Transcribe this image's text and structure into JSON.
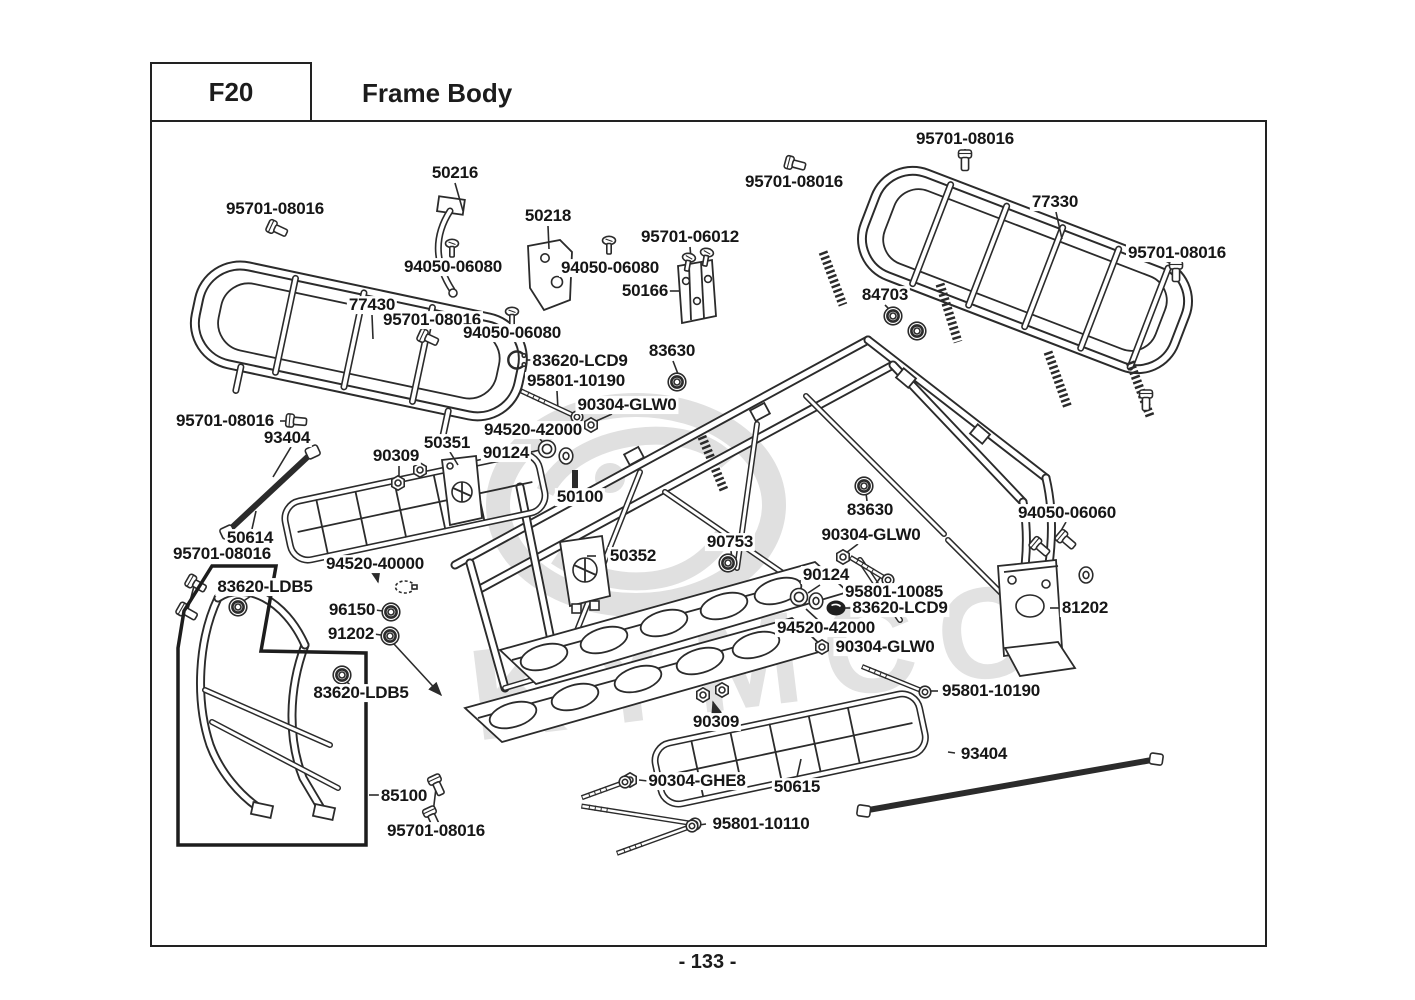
{
  "header": {
    "code": "F20",
    "title": "Frame Body"
  },
  "footer": {
    "page_number": "- 133 -"
  },
  "watermark": {
    "brand": "KYMCO"
  },
  "colors": {
    "line": "#2b2b2b",
    "label_text": "#161616",
    "border": "#222222",
    "watermark": "#e0e0e0",
    "background": "#ffffff"
  },
  "diagram": {
    "labels": [
      {
        "text": "95701-08016",
        "x": 275,
        "y": 209
      },
      {
        "text": "50216",
        "x": 455,
        "y": 173
      },
      {
        "text": "94050-06080",
        "x": 453,
        "y": 267
      },
      {
        "text": "50218",
        "x": 548,
        "y": 216
      },
      {
        "text": "94050-06080",
        "x": 610,
        "y": 268
      },
      {
        "text": "95701-06012",
        "x": 690,
        "y": 237
      },
      {
        "text": "50166",
        "x": 645,
        "y": 291
      },
      {
        "text": "95701-08016",
        "x": 965,
        "y": 139
      },
      {
        "text": "95701-08016",
        "x": 794,
        "y": 182
      },
      {
        "text": "77330",
        "x": 1055,
        "y": 202
      },
      {
        "text": "95701-08016",
        "x": 1177,
        "y": 253
      },
      {
        "text": "84703",
        "x": 885,
        "y": 295
      },
      {
        "text": "77430",
        "x": 372,
        "y": 305
      },
      {
        "text": "95701-08016",
        "x": 432,
        "y": 320
      },
      {
        "text": "94050-06080",
        "x": 512,
        "y": 333
      },
      {
        "text": "83620-LCD9",
        "x": 580,
        "y": 361
      },
      {
        "text": "83630",
        "x": 672,
        "y": 351
      },
      {
        "text": "95801-10190",
        "x": 576,
        "y": 381
      },
      {
        "text": "90304-GLW0",
        "x": 627,
        "y": 405
      },
      {
        "text": "94520-42000",
        "x": 533,
        "y": 430
      },
      {
        "text": "90124",
        "x": 506,
        "y": 453
      },
      {
        "text": "95701-08016",
        "x": 225,
        "y": 421
      },
      {
        "text": "93404",
        "x": 287,
        "y": 438
      },
      {
        "text": "90309",
        "x": 396,
        "y": 456
      },
      {
        "text": "50351",
        "x": 447,
        "y": 443
      },
      {
        "text": "50100",
        "x": 580,
        "y": 497
      },
      {
        "text": "50614",
        "x": 250,
        "y": 538
      },
      {
        "text": "95701-08016",
        "x": 222,
        "y": 554
      },
      {
        "text": "94520-40000",
        "x": 375,
        "y": 564
      },
      {
        "text": "83620-LDB5",
        "x": 265,
        "y": 587
      },
      {
        "text": "96150",
        "x": 352,
        "y": 610
      },
      {
        "text": "91202",
        "x": 351,
        "y": 634
      },
      {
        "text": "83620-LDB5",
        "x": 361,
        "y": 693
      },
      {
        "text": "50352",
        "x": 633,
        "y": 556
      },
      {
        "text": "90753",
        "x": 730,
        "y": 542
      },
      {
        "text": "83630",
        "x": 870,
        "y": 510
      },
      {
        "text": "90304-GLW0",
        "x": 871,
        "y": 535
      },
      {
        "text": "90124",
        "x": 826,
        "y": 575
      },
      {
        "text": "95801-10085",
        "x": 894,
        "y": 592
      },
      {
        "text": "83620-LCD9",
        "x": 900,
        "y": 608
      },
      {
        "text": "94520-42000",
        "x": 826,
        "y": 628
      },
      {
        "text": "90304-GLW0",
        "x": 885,
        "y": 647
      },
      {
        "text": "94050-06060",
        "x": 1067,
        "y": 513
      },
      {
        "text": "81202",
        "x": 1085,
        "y": 608
      },
      {
        "text": "95801-10190",
        "x": 991,
        "y": 691
      },
      {
        "text": "90309",
        "x": 716,
        "y": 722
      },
      {
        "text": "50615",
        "x": 797,
        "y": 787
      },
      {
        "text": "90304-GHE8",
        "x": 697,
        "y": 781
      },
      {
        "text": "93404",
        "x": 984,
        "y": 754
      },
      {
        "text": "95801-10110",
        "x": 761,
        "y": 824
      },
      {
        "text": "85100",
        "x": 404,
        "y": 796
      },
      {
        "text": "95701-08016",
        "x": 436,
        "y": 831
      }
    ],
    "hardware": [
      {
        "type": "bolt-icon",
        "x": 277,
        "y": 229,
        "rot": 25
      },
      {
        "type": "bolt-icon",
        "x": 795,
        "y": 164,
        "rot": 15
      },
      {
        "type": "bolt-icon",
        "x": 965,
        "y": 160,
        "rot": 90
      },
      {
        "type": "bolt-icon",
        "x": 1176,
        "y": 271,
        "rot": 90
      },
      {
        "type": "bolt-icon",
        "x": 1146,
        "y": 400,
        "rot": 90
      },
      {
        "type": "bolt-icon",
        "x": 428,
        "y": 338,
        "rot": 25
      },
      {
        "type": "bolt-icon",
        "x": 296,
        "y": 421,
        "rot": 5
      },
      {
        "type": "bolt-icon",
        "x": 196,
        "y": 584,
        "rot": 30
      },
      {
        "type": "bolt-icon",
        "x": 187,
        "y": 612,
        "rot": 30
      },
      {
        "type": "bolt-icon",
        "x": 437,
        "y": 785,
        "rot": 65
      },
      {
        "type": "bolt-icon",
        "x": 432,
        "y": 817,
        "rot": 65
      },
      {
        "type": "bolt-icon",
        "x": 1040,
        "y": 547,
        "rot": 40
      },
      {
        "type": "bolt-icon",
        "x": 1066,
        "y": 540,
        "rot": 40
      },
      {
        "type": "screw-icon",
        "x": 452,
        "y": 249,
        "rot": 0
      },
      {
        "type": "screw-icon",
        "x": 609,
        "y": 246,
        "rot": 0
      },
      {
        "type": "screw-icon",
        "x": 512,
        "y": 317,
        "rot": 0
      },
      {
        "type": "screw-icon",
        "x": 688,
        "y": 263,
        "rot": 10
      },
      {
        "type": "screw-icon",
        "x": 706,
        "y": 258,
        "rot": 10
      },
      {
        "type": "nut-icon",
        "x": 398,
        "y": 483
      },
      {
        "type": "nut-icon",
        "x": 420,
        "y": 470
      },
      {
        "type": "nut-icon",
        "x": 591,
        "y": 425
      },
      {
        "type": "nut-icon",
        "x": 843,
        "y": 557
      },
      {
        "type": "nut-icon",
        "x": 822,
        "y": 647
      },
      {
        "type": "nut-icon",
        "x": 630,
        "y": 780
      },
      {
        "type": "nut-icon",
        "x": 703,
        "y": 695
      },
      {
        "type": "nut-icon",
        "x": 722,
        "y": 690
      },
      {
        "type": "washer-ring-icon",
        "x": 547,
        "y": 449
      },
      {
        "type": "washer-icon",
        "x": 566,
        "y": 456
      },
      {
        "type": "washer-ring-icon",
        "x": 799,
        "y": 597
      },
      {
        "type": "washer-icon",
        "x": 816,
        "y": 601
      },
      {
        "type": "washer-icon",
        "x": 1086,
        "y": 575
      },
      {
        "type": "grommet-icon",
        "x": 677,
        "y": 382
      },
      {
        "type": "grommet-icon",
        "x": 864,
        "y": 486
      },
      {
        "type": "grommet-icon",
        "x": 893,
        "y": 316
      },
      {
        "type": "grommet-icon",
        "x": 917,
        "y": 331
      },
      {
        "type": "grommet-icon",
        "x": 391,
        "y": 612
      },
      {
        "type": "grommet-icon",
        "x": 390,
        "y": 636
      },
      {
        "type": "grommet-icon",
        "x": 238,
        "y": 607
      },
      {
        "type": "grommet-icon",
        "x": 342,
        "y": 675
      },
      {
        "type": "grommet-icon",
        "x": 728,
        "y": 563
      },
      {
        "type": "snap-ring-icon",
        "x": 517,
        "y": 360
      },
      {
        "type": "oring-icon",
        "x": 836,
        "y": 608
      },
      {
        "type": "clamp-icon",
        "x": 405,
        "y": 587
      },
      {
        "type": "long-bolt-icon",
        "x": 577,
        "y": 417,
        "rot": 25,
        "len": 62
      },
      {
        "type": "long-bolt-icon",
        "x": 925,
        "y": 692,
        "rot": 22,
        "len": 68
      },
      {
        "type": "long-bolt-icon",
        "x": 888,
        "y": 580,
        "rot": 31,
        "len": 44
      },
      {
        "type": "long-bolt-icon",
        "x": 695,
        "y": 824,
        "rot": 9,
        "len": 115
      },
      {
        "type": "long-bolt-icon",
        "x": 692,
        "y": 826,
        "rot": -20,
        "len": 80
      },
      {
        "type": "long-bolt-icon",
        "x": 625,
        "y": 782,
        "rot": -20,
        "len": 46
      },
      {
        "type": "tie-rod-icon",
        "x": 270,
        "y": 492,
        "rot": -43,
        "len": 110
      },
      {
        "type": "tie-rod-icon",
        "x": 1010,
        "y": 785,
        "rot": -10,
        "len": 290
      }
    ]
  }
}
